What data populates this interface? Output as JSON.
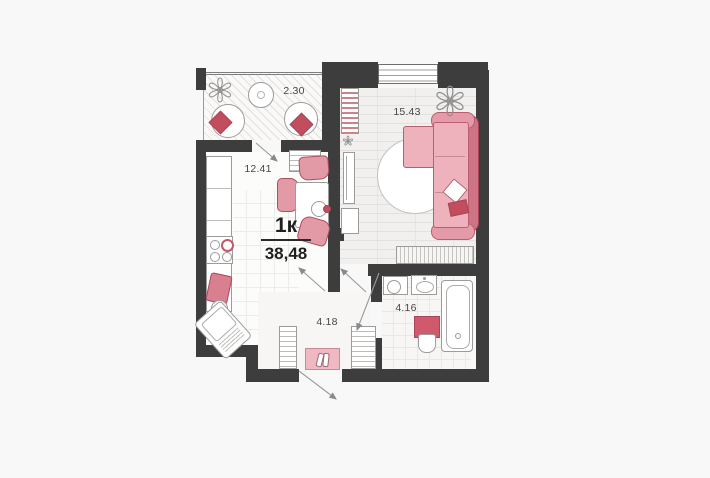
{
  "plan": {
    "title": "1к",
    "total_area": "38,48",
    "rooms": [
      {
        "name": "loggia",
        "area_label": "2.30"
      },
      {
        "name": "living-room",
        "area_label": "15.43"
      },
      {
        "name": "kitchen",
        "area_label": "12.41"
      },
      {
        "name": "hallway",
        "area_label": "4.18"
      },
      {
        "name": "bathroom",
        "area_label": "4.16"
      }
    ],
    "colors": {
      "background": "#f8f8f8",
      "wall": "#3d3d3d",
      "accent_pink": "#eeb2bc",
      "accent_dark_pink": "#c24d5c"
    }
  }
}
